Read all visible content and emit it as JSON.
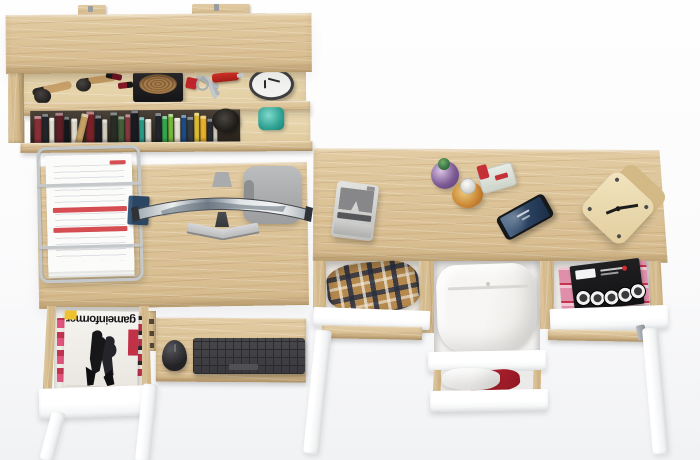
{
  "scene": {
    "description": "Top-down render of an oak home-office set: wall shelf with accessories and books, desk with curved monitor, keyboard tray and open magazine drawer, plus a second desk with three open drawers of clothing and magazines",
    "background_top": "#fefefe",
    "background_bottom": "#f1f2f4"
  },
  "palette": {
    "oak_wood": "#d8bd92",
    "oak_light": "#e7d6ae",
    "oak_edge": "#a8895c",
    "drawer_white": "#ffffff",
    "keyboard_gray": "#434347",
    "chair_gray": "#adaeb0",
    "accent_red": "#c2272d",
    "teal_glass": "#2fa193",
    "plaid_navy": "#2c3442",
    "plaid_tan": "#b5894e",
    "magazine_pink": "#e08fab",
    "phone_screen_blue": "#426082"
  },
  "shelf": {
    "items": [
      "makeup-brushes",
      "lipsticks",
      "basket-in-tray",
      "keys-with-red-fob",
      "pocket-knife",
      "alarm-clock",
      "camera-lens",
      "teal-glass",
      "books"
    ],
    "books": [
      {
        "c": "#8d3038",
        "w": 7,
        "h": 28
      },
      {
        "c": "#23262c",
        "w": 6,
        "h": 30
      },
      {
        "c": "#eee8da",
        "w": 5,
        "h": 26
      },
      {
        "c": "#5d2027",
        "w": 8,
        "h": 31
      },
      {
        "c": "#16191f",
        "w": 5,
        "h": 27
      },
      {
        "c": "#e5dfd2",
        "w": 6,
        "h": 25,
        "g": 2
      },
      {
        "c": "#c9a467",
        "w": 7,
        "h": 30,
        "r": 14
      },
      {
        "c": "#7c2129",
        "w": 8,
        "h": 32
      },
      {
        "c": "#1a1d23",
        "w": 6,
        "h": 28
      },
      {
        "c": "#dcd6c8",
        "w": 5,
        "h": 24
      },
      {
        "c": "#2a2e26",
        "w": 7,
        "h": 31,
        "g": 3
      },
      {
        "c": "#44613c",
        "w": 6,
        "h": 27
      },
      {
        "c": "#8e3a42",
        "w": 5,
        "h": 29
      },
      {
        "c": "#191c22",
        "w": 7,
        "h": 33
      },
      {
        "c": "#2aa18f",
        "w": 5,
        "h": 26
      },
      {
        "c": "#e6e1d5",
        "w": 6,
        "h": 24
      },
      {
        "c": "#23272d",
        "w": 6,
        "h": 30,
        "g": 4
      },
      {
        "c": "#35b152",
        "w": 5,
        "h": 27
      },
      {
        "c": "#7ec13f",
        "w": 5,
        "h": 29
      },
      {
        "c": "#e9e5da",
        "w": 6,
        "h": 25
      },
      {
        "c": "#1d508c",
        "w": 5,
        "h": 28
      },
      {
        "c": "#383d44",
        "w": 6,
        "h": 26
      },
      {
        "c": "#e5c534",
        "w": 5,
        "h": 30
      },
      {
        "c": "#f0b42c",
        "w": 6,
        "h": 27
      },
      {
        "c": "#2b2f36",
        "w": 5,
        "h": 24
      },
      {
        "c": "#ded9cc",
        "w": 4,
        "h": 22
      }
    ]
  },
  "left_desk": {
    "objects": [
      "wire-document-tray",
      "blue-notebook",
      "curved-monitor",
      "office-chair",
      "keyboard",
      "mouse"
    ],
    "magazine_title": "gameinformer",
    "drawer_contents": "video-game magazines"
  },
  "right_desk": {
    "objects": [
      "printer",
      "perfume-bottles",
      "smartphone",
      "wooden-cube-clock"
    ],
    "drawer_contents": [
      "plaid-shirt",
      "white-trousers",
      "white-and-red-garment",
      "music-magazines"
    ]
  }
}
